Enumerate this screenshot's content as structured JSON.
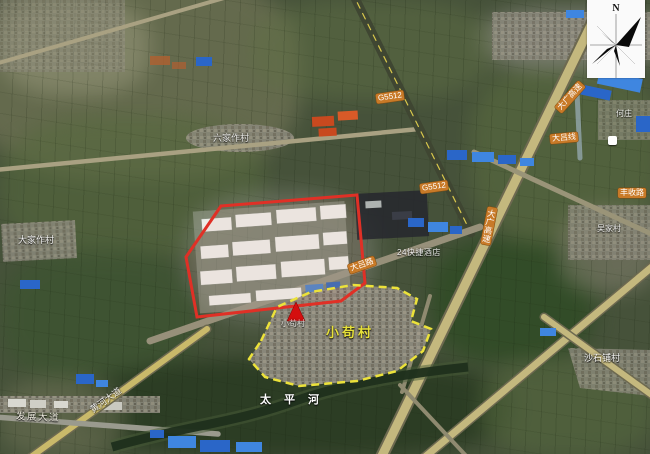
{
  "compass": {
    "n": "N"
  },
  "colors": {
    "red_boundary": "#e03026",
    "yellow_boundary": "#ece23a",
    "marker_red": "#d40f0f",
    "badge_orange": "#c87a28",
    "village_label_yellow": "#e6e03a"
  },
  "labels": {
    "village_main_yellow": "小苟村",
    "village_main_map": "小苟村",
    "village_liujiazuo": "六家作村",
    "village_dajiazuo": "大家作村",
    "village_wujia": "吴家村",
    "village_shashipu": "沙石铺村",
    "village_hezhuang": "何庄",
    "river_taipinghe": "太平河",
    "road_fazhan_avenue": "发展大道",
    "road_huanghe_avenue": "黄河大道",
    "road_dalv_road": "大吕路",
    "road_dalv_line": "大吕线",
    "road_fengshou": "丰收路",
    "expressway_badge_vertical": "大广高速",
    "expressway_badge_diagonal": "大广高速",
    "highway_badge_1": "G5512",
    "highway_badge_2": "G5512",
    "hotel": "24快捷酒店"
  }
}
